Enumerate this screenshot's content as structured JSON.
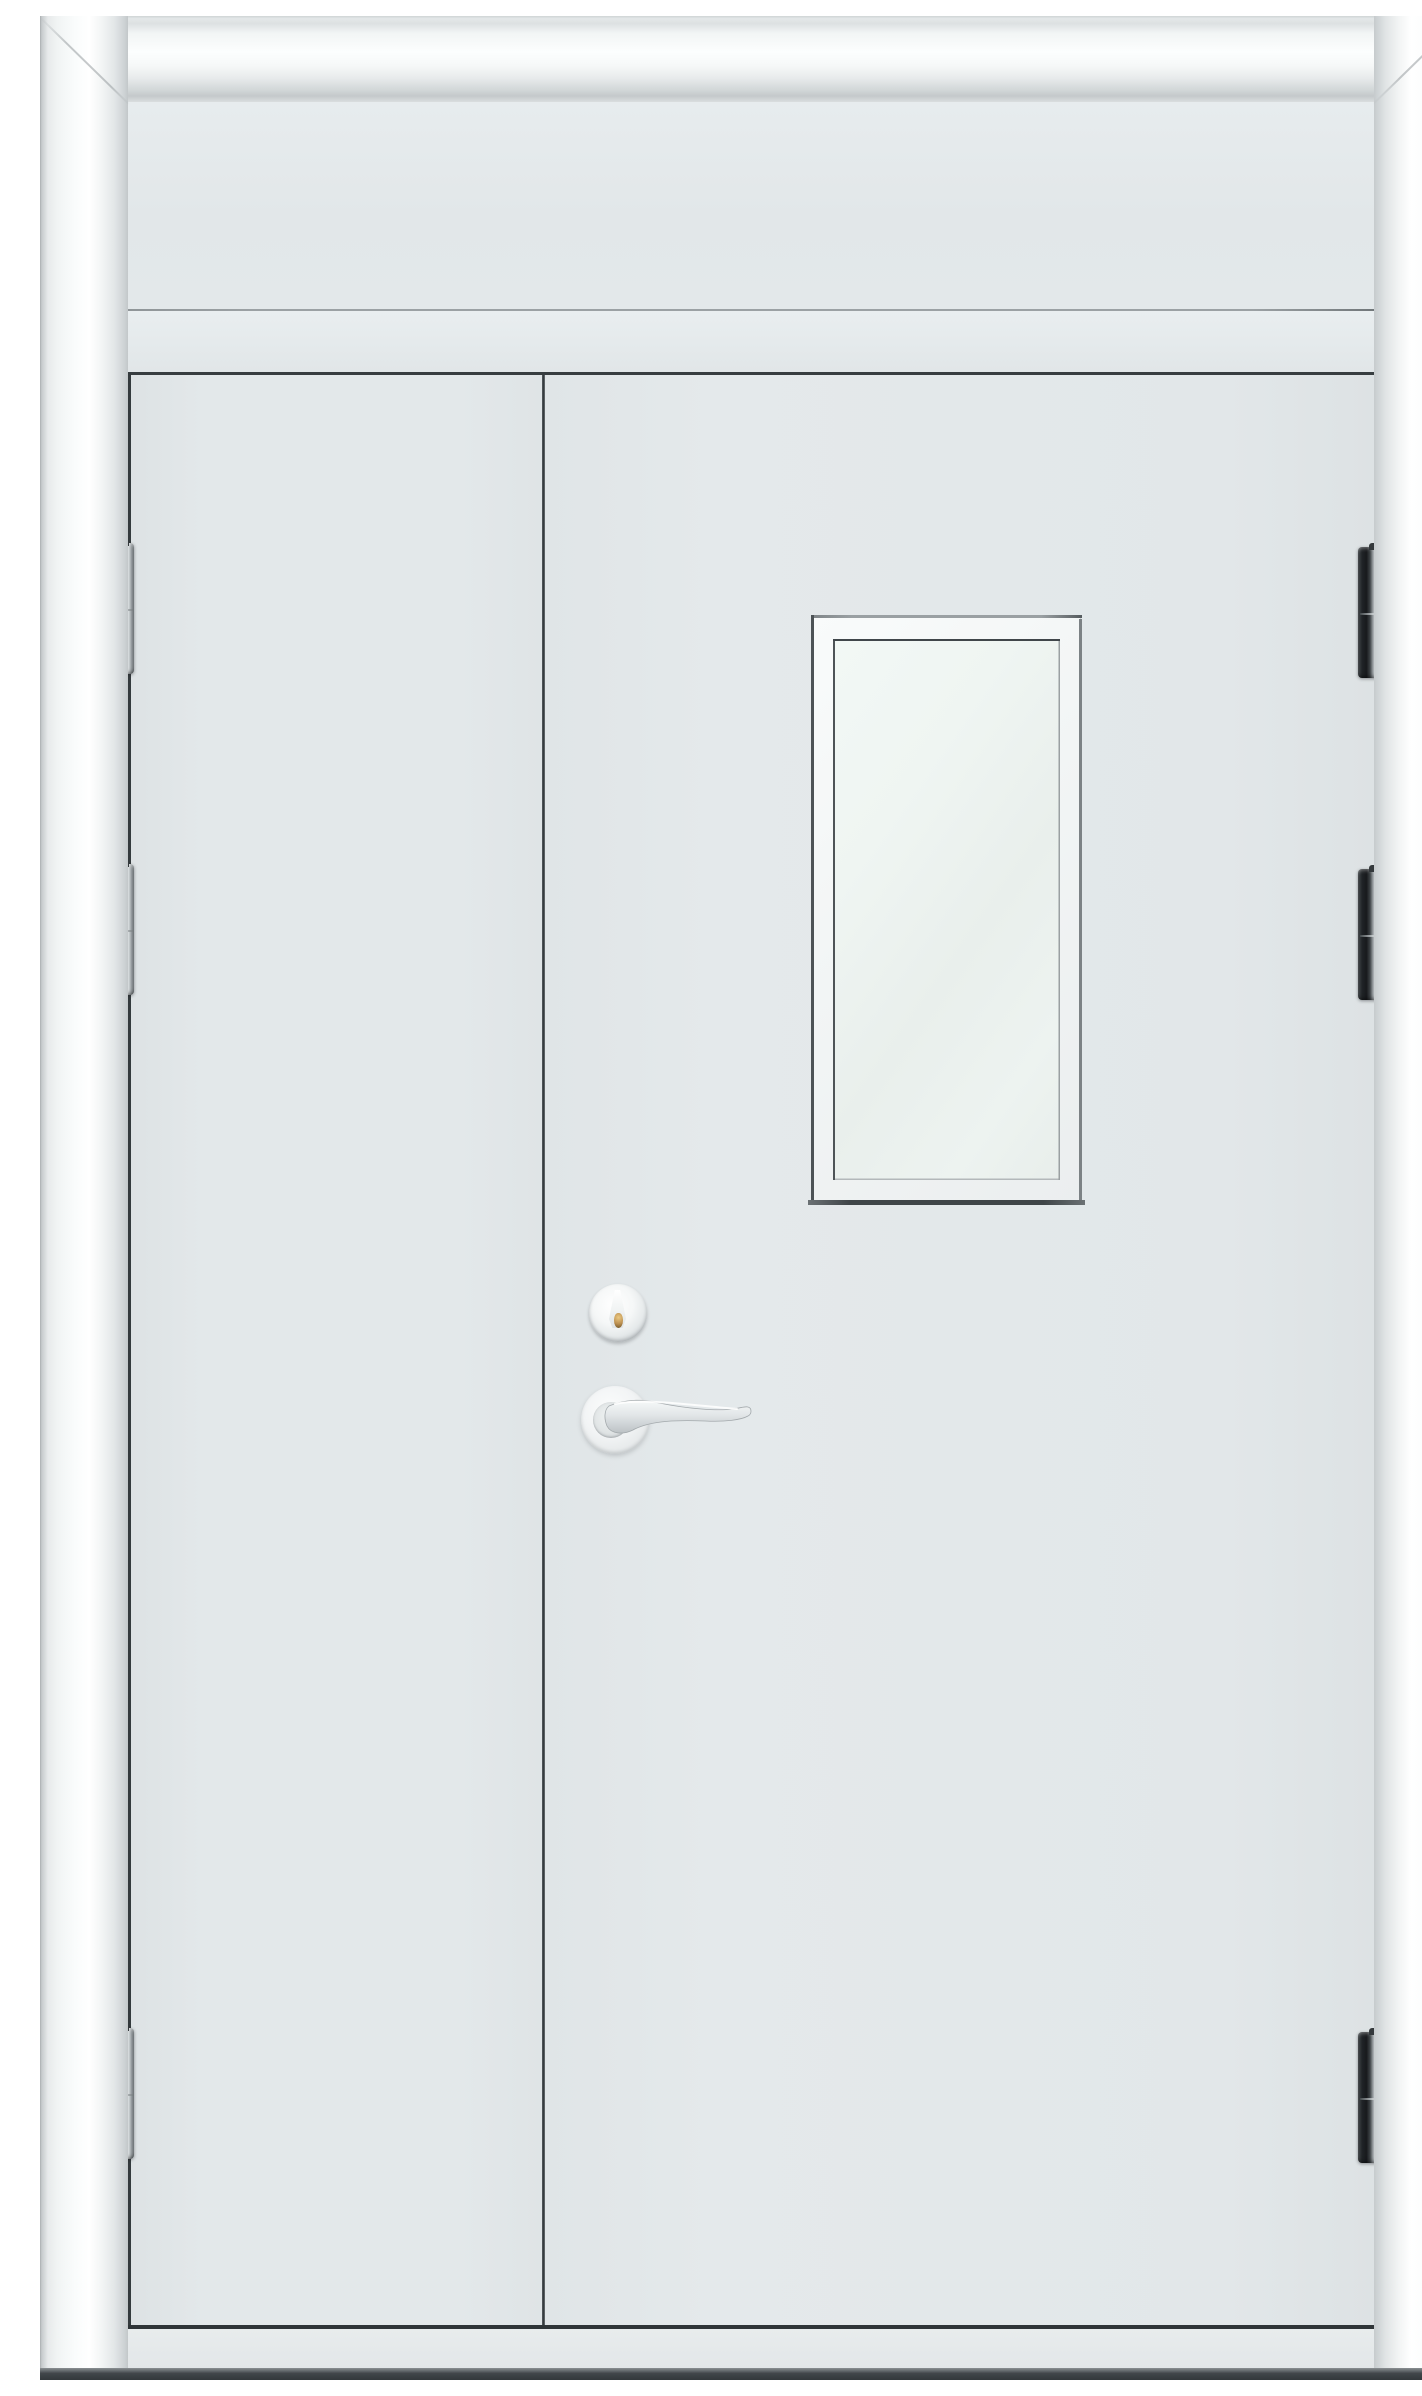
{
  "scene": {
    "type": "product-photo",
    "description": "White unequal double steel door with moulded architrave frame, transom panel above, rectangular vision window in the wide right leaf, cylinder lock and stainless lever handle near the meeting stile, and six dark barrel hinges",
    "door": {
      "leaves": 2,
      "leaf_arrangement": "narrow left leaf, wide right leaf",
      "transom_panel": true,
      "vision_window": {
        "count": 1,
        "shape": "vertical rectangle",
        "location": "upper right leaf"
      },
      "hardware": {
        "cylinder_lock": {
          "count": 1,
          "keyway_color_name": "brass"
        },
        "lever_handle": {
          "count": 1,
          "style": "curved stainless lever on round rose"
        }
      },
      "hinges": {
        "count": 6,
        "per_side": 3,
        "finish": "dark steel barrel with bright edge"
      }
    }
  },
  "colors": {
    "door-face": "#e2e7e9",
    "transom-face": "#e5eaec",
    "frame-white": "#fbfdfd",
    "frame-shadow": "#c4c9cb",
    "panel-gap-dark": "#32383b",
    "glass": "#edf3f0",
    "window-frame": "#f4f7f7",
    "hinge-dark": "#17191c",
    "hinge-bright": "#e7ebed",
    "hardware-silver": "#d3d8da",
    "keyway-brass": "#bb8f50",
    "floor-dark": "#3d4245"
  }
}
